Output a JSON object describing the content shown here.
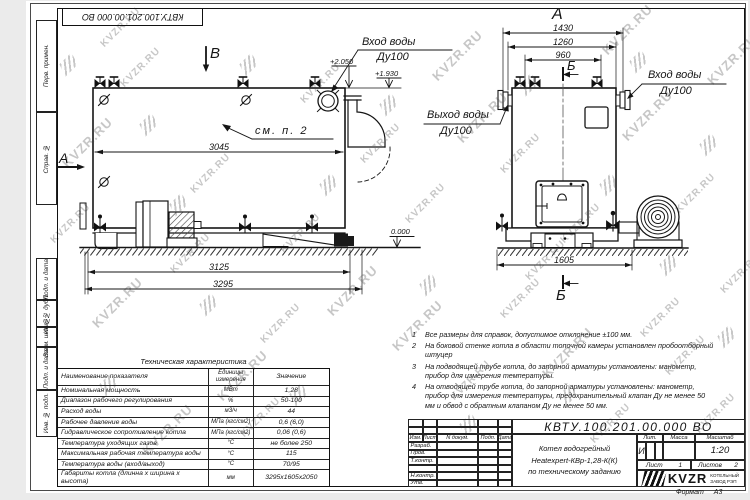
{
  "doc": {
    "number": "КВТУ.100.201.00.000 ВО",
    "title_lines": [
      "Котел водогрейный",
      "Heatexpert-КВр-1,28-К(К)",
      "по техническому заданию"
    ],
    "liter_label": "Лит.",
    "liter_value": "И",
    "mass_label": "Масса",
    "scale_label": "Масштаб",
    "scale_value": "1:20",
    "sheet_label": "Лист",
    "sheet_value": "1",
    "sheets_label": "Листов",
    "sheets_value": "2",
    "format_label": "Формат",
    "format_value": "А3",
    "company": {
      "logo_text": "KVZR",
      "name_line1": "КОТЕЛЬНЫЙ",
      "name_line2": "ЗАВОД РЭП"
    },
    "rev_headers": [
      "Изм.",
      "Лист",
      "N докум.",
      "Подп.",
      "Дата"
    ],
    "sig_rows": [
      "Разраб.",
      "Пров.",
      "Т.контр.",
      "",
      "Н.контр.",
      "Утв."
    ]
  },
  "margins": {
    "left_boxes": [
      "Перв. примен.",
      "Справ. №",
      "Подп. и дата",
      "Инв. № дубл.",
      "Взам. инв. №",
      "Подп. и дата",
      "Инв. № подл."
    ]
  },
  "views": {
    "left": {
      "label": "В",
      "section_label": "А",
      "note_ref": "см. п. 2",
      "inlet_line1": "Вход воды",
      "inlet_line2": "Ду100",
      "dims": {
        "d3045": "3045",
        "d3125": "3125",
        "d3295": "3295"
      },
      "elevations": {
        "e1": "+2.050",
        "e2": "+1.930",
        "e0": "0.000"
      }
    },
    "right": {
      "label": "А",
      "section_label": "Б",
      "outlet_line1": "Выход воды",
      "outlet_line2": "Ду100",
      "inlet_line1": "Вход воды",
      "inlet_line2": "Ду100",
      "dims": {
        "d1430": "1430",
        "d1260": "1260",
        "d960": "960",
        "d1605": "1605"
      }
    }
  },
  "notes": [
    {
      "num": "1",
      "text": "Все размеры для справок, допустимое отклонение ±100 мм."
    },
    {
      "num": "2",
      "text": "На боковой стенке котла в области топочной камеры установлен пробоотборный штуцер"
    },
    {
      "num": "3",
      "text": "На подводящей трубе котла, до запорной арматуры установлены: манометр, прибор для измерения температуры."
    },
    {
      "num": "4",
      "text": "На отводящей трубе котла, до запорной арматуры установлены: манометр, прибор для измерения температуры, предохранительный клапан Ду не менее 50 мм и обвод с обратным клапаном Ду не менее 50 мм."
    }
  ],
  "spec_table": {
    "title": "Техническая характеристика",
    "headers": [
      "Наименование показателя",
      "Единицы измерения",
      "Значение"
    ],
    "rows": [
      [
        "Номинальная мощность",
        "МВт",
        "1,28"
      ],
      [
        "Диапазон рабочего регулирования",
        "%",
        "50-100"
      ],
      [
        "Расход воды",
        "м3/ч",
        "44"
      ],
      [
        "Рабочее давление воды",
        "МПа (кгс/см2)",
        "0,6 (6,0)"
      ],
      [
        "Гидравлическое сопротивление котла",
        "МПа (кгс/см2)",
        "0,06 (0,6)"
      ],
      [
        "Температура уходящих газов",
        "°С",
        "не более 250"
      ],
      [
        "Максимальная рабочая температура воды",
        "°С",
        "115"
      ],
      [
        "Температура воды (вход/выход)",
        "°С",
        "70/95"
      ],
      [
        "Габариты котла (длинна х ширина х высота)",
        "мм",
        "3295х1605х2050"
      ]
    ]
  },
  "watermark": {
    "text": "KVZR.RU"
  },
  "colors": {
    "line": "#151515",
    "watermark": "#c7c7c7"
  }
}
